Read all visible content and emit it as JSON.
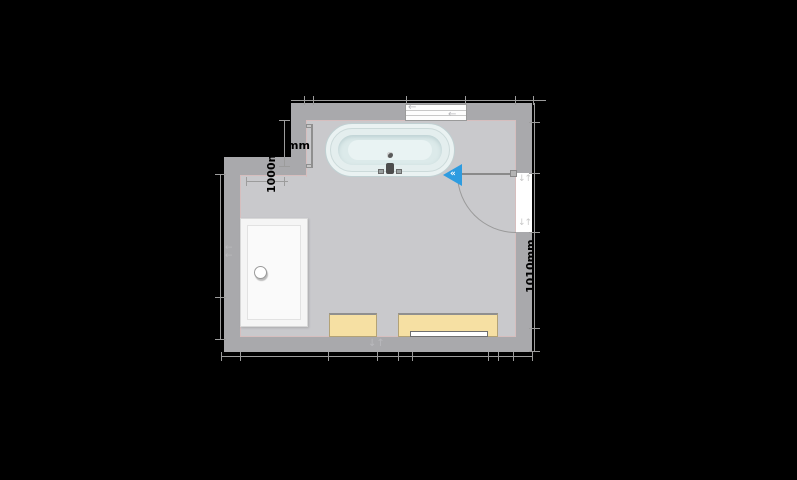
{
  "plan": {
    "type": "bathroom-floor-plan",
    "dimensions": {
      "left_wall_offset": "1000mm",
      "upper_left_fragment": "mm",
      "right_lower_segment": "1010mm"
    },
    "icons": {
      "slide_left_arrow": "←",
      "swap_vertical_arrows": "↓↑",
      "wall_drag_arrow": "←",
      "door_marker_chevrons": "«"
    },
    "colors": {
      "background": "#000000",
      "wall": "#a9a9ac",
      "floor": "#c9c9cc",
      "floor_outline": "#d6bebe",
      "dimension_line": "#9c9c9c",
      "dimension_text": "#000000",
      "cabinet": "#f6e0a3",
      "door_swing_marker": "#2e9ce0",
      "bathtub": "#e9f2f2",
      "shower_tray": "#f5f5f5",
      "window": "#ffffff"
    }
  }
}
